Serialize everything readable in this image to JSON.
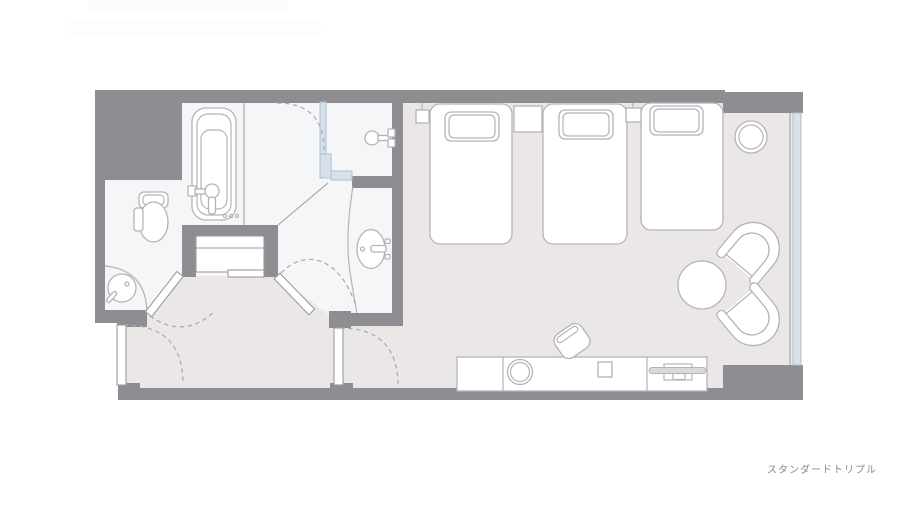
{
  "caption": {
    "text": "スタンダードトリプル"
  },
  "floorplan": {
    "kind": "hotel-room-floor-plan",
    "room_type_label": "スタンダードトリプル",
    "colors": {
      "wall": "#8e8e92",
      "bedroom_floor": "#eae7e6",
      "bathroom_floor": "#f5f6f8",
      "furniture_stroke": "#b4b4b8",
      "furniture_fill": "#ffffff",
      "glass": "#d7e1ec",
      "dashed_line": "#a9a9ad",
      "caption_text": "#8a8a8a"
    },
    "symbols": [
      "bathtub",
      "bath-faucet",
      "shower-head",
      "washbasin",
      "vanity-counter",
      "toilet",
      "corner-basin",
      "entry-door",
      "toilet-door",
      "powder-room-door",
      "bedroom-door",
      "bed-1",
      "bed-2",
      "bed-3",
      "pillow",
      "nightstand",
      "wall-lamp",
      "floor-lamp",
      "armchair",
      "round-table",
      "desk",
      "desk-chair",
      "kettle",
      "tv",
      "window",
      "shower-glass-partition"
    ]
  }
}
